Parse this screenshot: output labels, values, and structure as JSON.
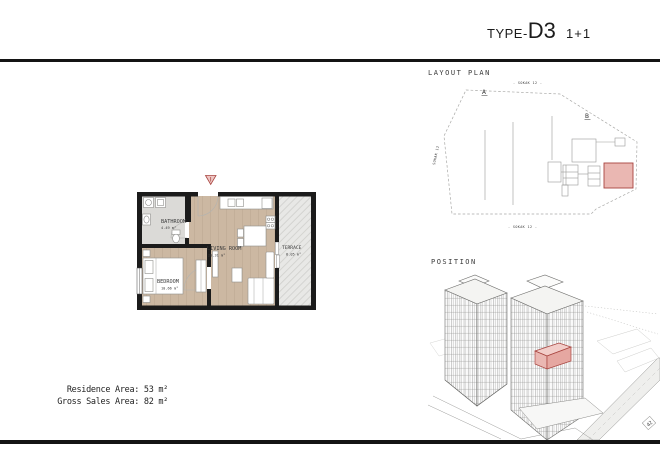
{
  "header": {
    "type_prefix": "TYPE-",
    "type_code": "D3",
    "unit_type": "1+1"
  },
  "plan": {
    "rooms": [
      {
        "name": "BATHROOM",
        "area": "4.49 m²"
      },
      {
        "name": "BEDROOM",
        "area": "10.66 m²"
      },
      {
        "name": "LIVING ROOM",
        "area": "20.31 m²"
      },
      {
        "name": "TERRACE",
        "area": "8.05 m²"
      }
    ]
  },
  "summary": {
    "residence_area": "Residence Area: 53 m²",
    "gross_sales_area": "Gross Sales Area: 82 m²"
  },
  "layout_plan": {
    "title": "LAYOUT PLAN",
    "block_a": "A",
    "block_b": "B",
    "street_top": "- SOKAK 12 -",
    "street_bottom": "- SOKAK 12 -",
    "street_left": "SOKAK 12"
  },
  "position": {
    "title": "POSITION",
    "road_label": "42"
  },
  "colors": {
    "wall_black": "#1b1b1b",
    "wood_floor": "#cbb7a1",
    "bath_floor": "#dbdad7",
    "terrace_floor": "#e7e7e5",
    "highlight_fill": "#eab7b2",
    "highlight_stroke": "#a8443f"
  }
}
